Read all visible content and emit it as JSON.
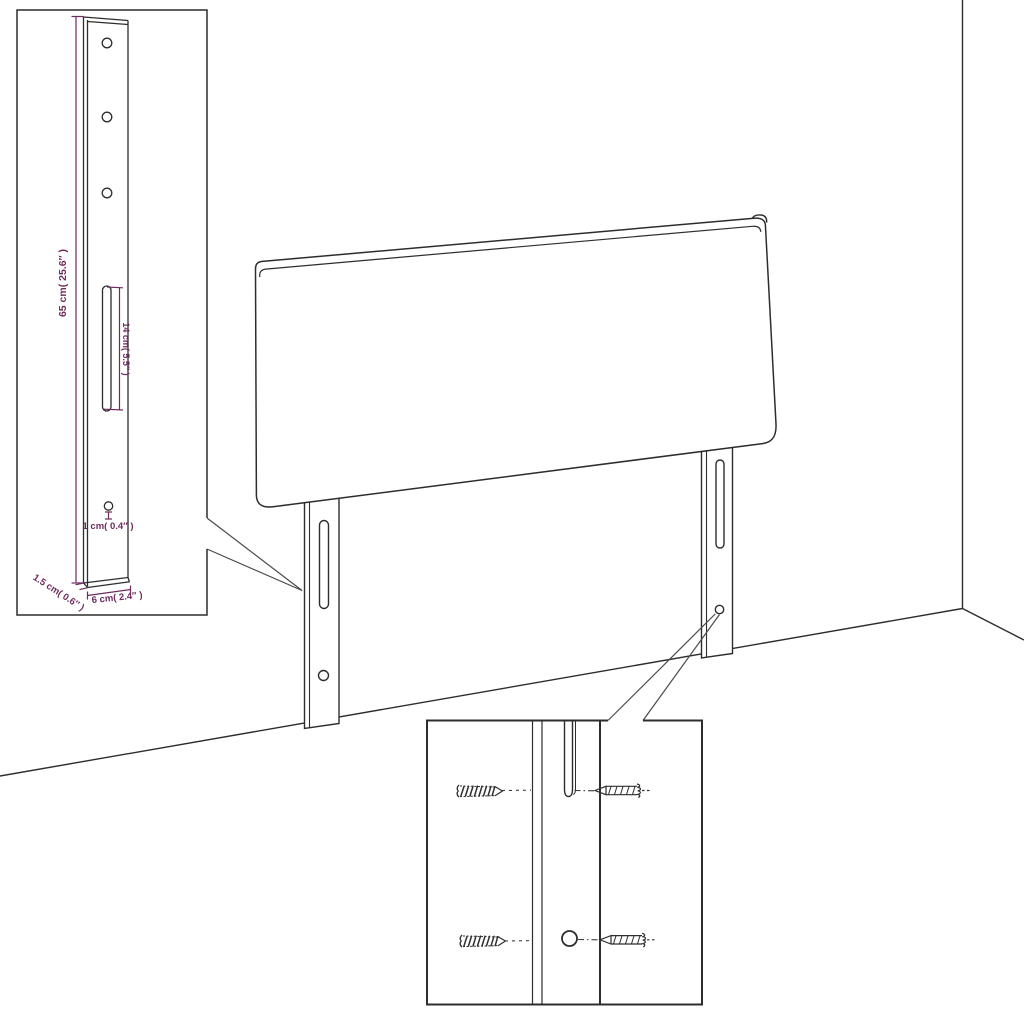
{
  "diagram": {
    "kind": "headboard-assembly-dimension-diagram",
    "colors": {
      "background": "#ffffff",
      "line": "#2d2d2d",
      "callout": "#4a4a4a",
      "dimension": "#6e2b5e"
    },
    "bracket_inset": {
      "labels": {
        "total_height": "65 cm( 25.6″ )",
        "slot_length": "14 cm( 5.5″ )",
        "hole_size": "1 cm( 0.4″ )",
        "side_depth": "1.5 cm( 0.6″ )",
        "bracket_width": "6 cm( 2.4″ )"
      },
      "hole_count": 4,
      "slot_count": 1
    },
    "screw_inset": {
      "screw_count": 4,
      "hole_count": 1,
      "slot_count": 1
    },
    "scene": {
      "legs": 2,
      "wall_corner": true
    }
  }
}
